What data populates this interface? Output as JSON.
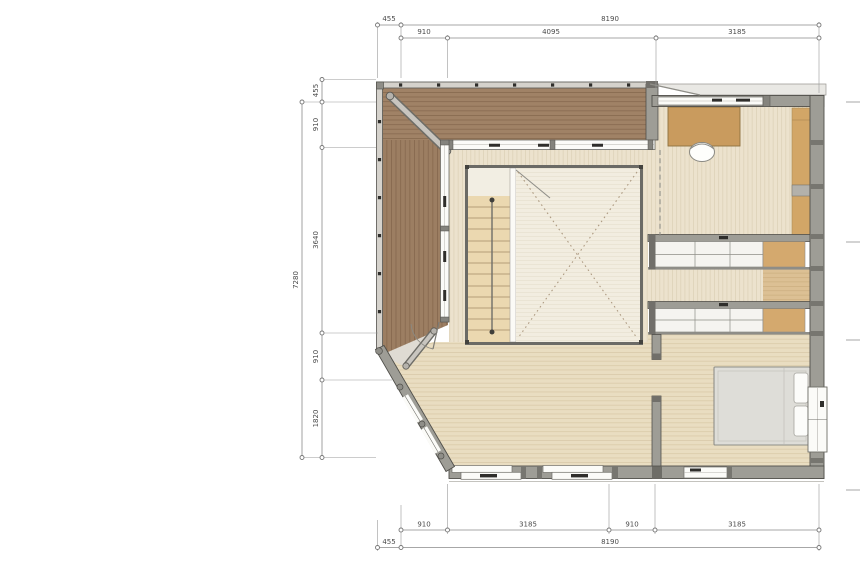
{
  "dimensions": {
    "top_outer": [
      "455",
      "8190"
    ],
    "top_inner": [
      "910",
      "4095",
      "3185"
    ],
    "left_outer": [
      "7280"
    ],
    "left_inner": [
      "455",
      "910",
      "3640",
      "910",
      "1820"
    ],
    "bottom_inner": [
      "910",
      "3185",
      "910",
      "3185"
    ],
    "bottom_outer": [
      "455",
      "8190"
    ]
  },
  "colors": {
    "deck_wood": "#9c7e62",
    "deck_seam": "#85674d",
    "floor_light": "#ece2cd",
    "floor_bottom": "#e9ddc1",
    "void_floor": "#f2ede0",
    "stair_wood": "#ebd8b0",
    "tatami_brown": "#d4a96e",
    "wall_grey": "#9e9d96",
    "wall_outline": "#504f4a",
    "window_white": "#fbfbf8",
    "furniture_brown": "#c99b5e",
    "bed_grey": "#deddd8",
    "dimension_line": "#8a8a8a",
    "dimension_text": "#4b4b4b"
  }
}
